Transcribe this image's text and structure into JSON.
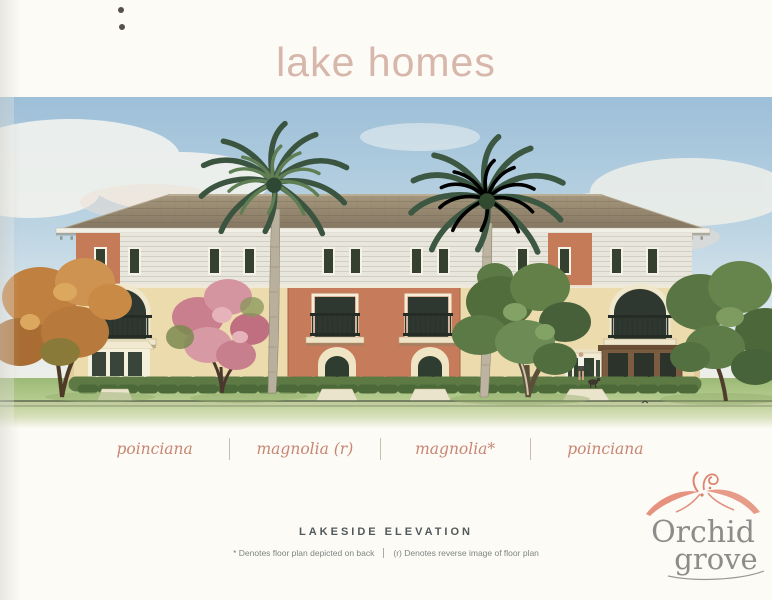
{
  "page": {
    "title": "lake homes"
  },
  "units": {
    "labels": [
      "poinciana",
      "magnolia (r)",
      "magnolia*",
      "poinciana"
    ]
  },
  "caption": {
    "heading": "LAKESIDE ELEVATION",
    "footnotes": {
      "left": "* Denotes floor plan depicted on back",
      "right": "(r) Denotes reverse image of floor plan"
    }
  },
  "logo": {
    "line1": "Orchid",
    "line2": "grove"
  },
  "illustration": {
    "description": "Watercolor lakeside elevation of a three-story lake homes building with hipped shingle roof, white clapboard upper floor, cream and terracotta stucco, iron balconies, royal palm trees, flowering and shade trees, hedges and lawn"
  },
  "colors": {
    "title": "#d7b6ab",
    "label": "#c98573",
    "heading": "#51595c",
    "footnote": "#7f8481",
    "logoText": "#8c8c8a",
    "logoFlower": "#e5927f",
    "sky": "#a9c7dd",
    "roof": "#988a72",
    "cream": "#ecdbac",
    "terracotta": "#c67c5b",
    "lawn": "#b2ca8b"
  }
}
